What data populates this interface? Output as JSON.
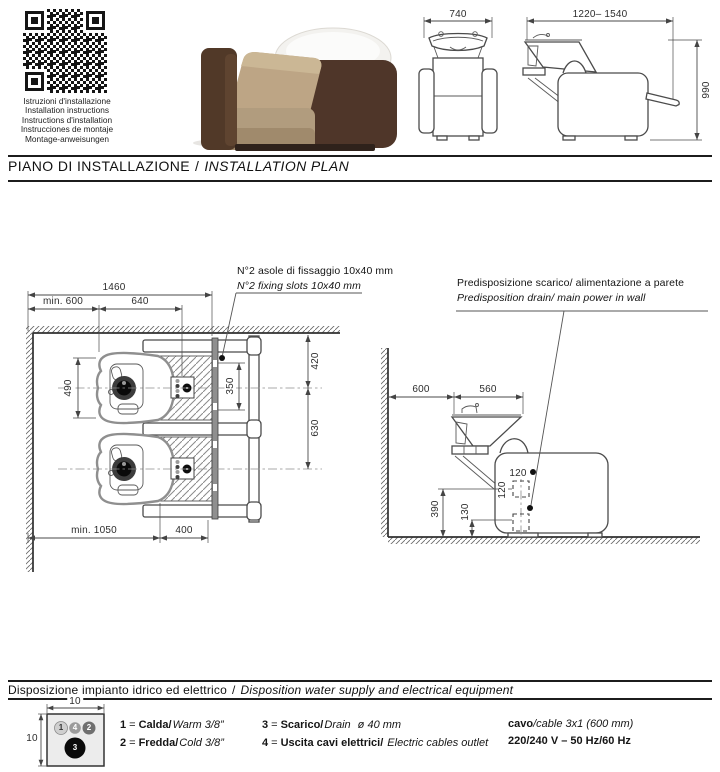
{
  "header": {
    "qr_caption_lines": [
      "Istruzioni d'installazione",
      "Installation instructions",
      "Instructions d'installation",
      "Instrucciones de montaje",
      "Montage-anweisungen"
    ]
  },
  "section_installation": {
    "title_it": "PIANO DI INSTALLAZIONE",
    "title_sep": "/",
    "title_en": "INSTALLATION PLAN",
    "annotation_fixing_it": "N°2 asole di fissaggio 10x40 mm",
    "annotation_fixing_en": "N°2 fixing slots 10x40 mm",
    "annotation_wall_it": "Predisposizione scarico/ alimentazione a parete",
    "annotation_wall_en": "Predisposition drain/ main power in wall"
  },
  "dims": {
    "front_width": "740",
    "side_width": "1220– 1540",
    "side_height": "990",
    "plan_total": "1460",
    "plan_min_wall": "min. 600",
    "plan_chair": "640",
    "plan_seat": "490",
    "plan_wall_center": "420",
    "plan_slots": "350",
    "plan_centers": "630",
    "plan_min_depth": "min. 1050",
    "plan_frame": "400",
    "elev_wall": "600",
    "elev_basin": "560",
    "elev_zone_w": "120",
    "elev_zone_h": "120",
    "elev_power": "390",
    "elev_drain": "130",
    "util_w": "10",
    "util_h": "10"
  },
  "section_utilities": {
    "title_it": "Disposizione impianto idrico ed elettrico",
    "title_sep": "/",
    "title_en": "Disposition water supply and electrical equipment",
    "points": {
      "p1": "1",
      "p2": "2",
      "p3": "3",
      "p4": "4"
    },
    "legend_items": [
      {
        "num": "1",
        "eq": "=",
        "it": "Calda/",
        "en": "Warm 3/8”",
        "extra": ""
      },
      {
        "num": "2",
        "eq": "=",
        "it": "Fredda/",
        "en": "Cold 3/8”",
        "extra": ""
      },
      {
        "num": "3",
        "eq": "=",
        "it": "Scarico/",
        "en": "Drain",
        "extra": "ø 40 mm"
      },
      {
        "num": "4",
        "eq": "=",
        "it": "Uscita cavi elettrici/",
        "en": "Electric cables outlet",
        "extra": ""
      }
    ],
    "cable_it": "cavo",
    "cable_en": "/cable 3x1 (600 mm)",
    "cable_power": "220/240 V – 50 Hz/60 Hz"
  }
}
